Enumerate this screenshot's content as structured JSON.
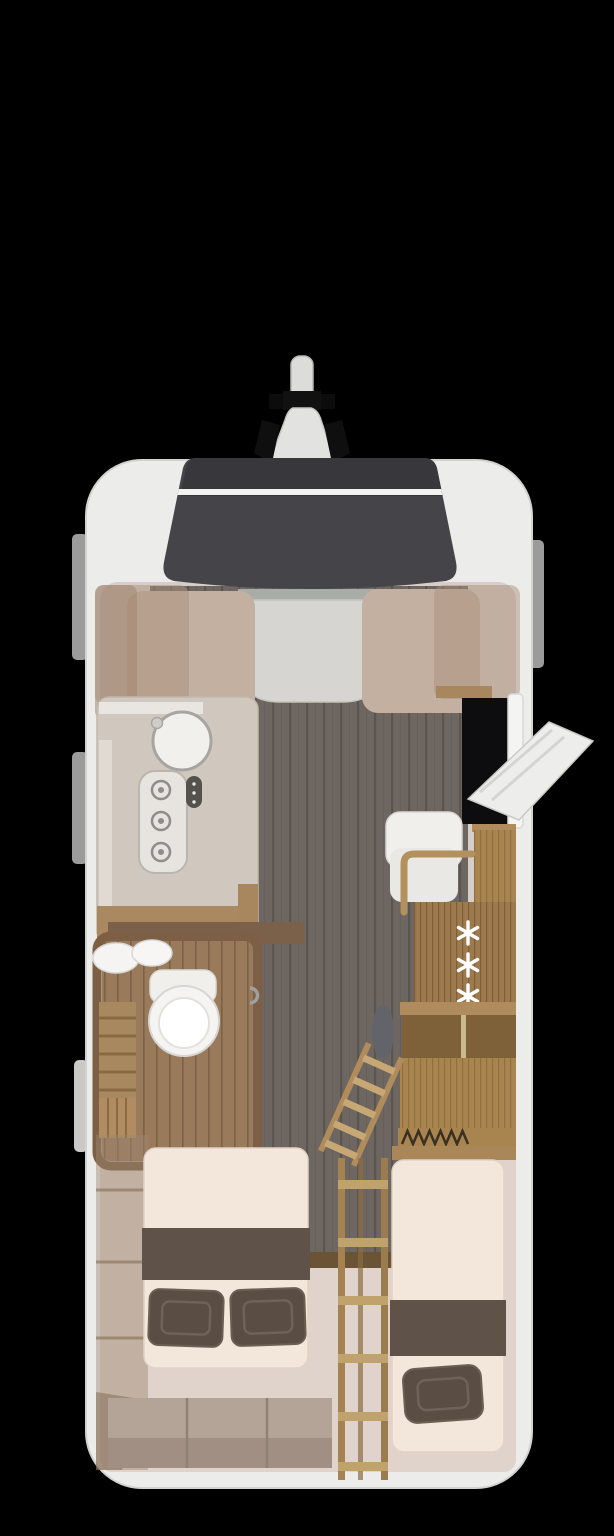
{
  "colors": {
    "background": "#000000",
    "shell": "#ececeb",
    "shellEdge": "#d7d7d5",
    "windowDark": "#38373b",
    "windowLower": "#454449",
    "windowStripe": "#f2f2f0",
    "interior": "#d6cfc9",
    "bedroomFloor": "#e0d3cc",
    "corridorPlank": "#6e6661",
    "seat": "#c3b0a1",
    "table": "#d7d5d1",
    "tableShelf": "#a9ada7",
    "counter": "#d0c8be",
    "counterWood": "#aa8962",
    "sinkWhite": "#f2f0ed",
    "hobFace": "#e7e4df",
    "fixtureWhite": "#f5f4f2",
    "bathFloorWood": "#997a5b",
    "bathWallWood": "#7c5f44",
    "benchWood": "#a8885e",
    "woodLight": "#a8854f",
    "woodMid": "#9c7a4e",
    "shelfInterior": "#7e6139",
    "mattress": "#f3e6db",
    "bedRunner": "#5f5349",
    "pillow": "#5a4e44",
    "steps": "#b3a497",
    "stepsFront": "#a08f82",
    "ladderWood": "#a5824f",
    "ladderRung": "#c0a26c",
    "doorLeaf": "#ededeb",
    "doorway": "#0d0d0f",
    "doorFrame": "#f4f4f2",
    "sideTab": "#9b9b9b",
    "snowflake": "#ffffff",
    "appliance": "#f0efec",
    "cushionGrey": "#63636a",
    "threshold": "#6b5336",
    "hitchCone": "#e2e2e1",
    "hitchBlack": "#111111"
  },
  "icons": {
    "fridge_marker": "six-point-asterisk",
    "fridge_marker_count": 3
  }
}
